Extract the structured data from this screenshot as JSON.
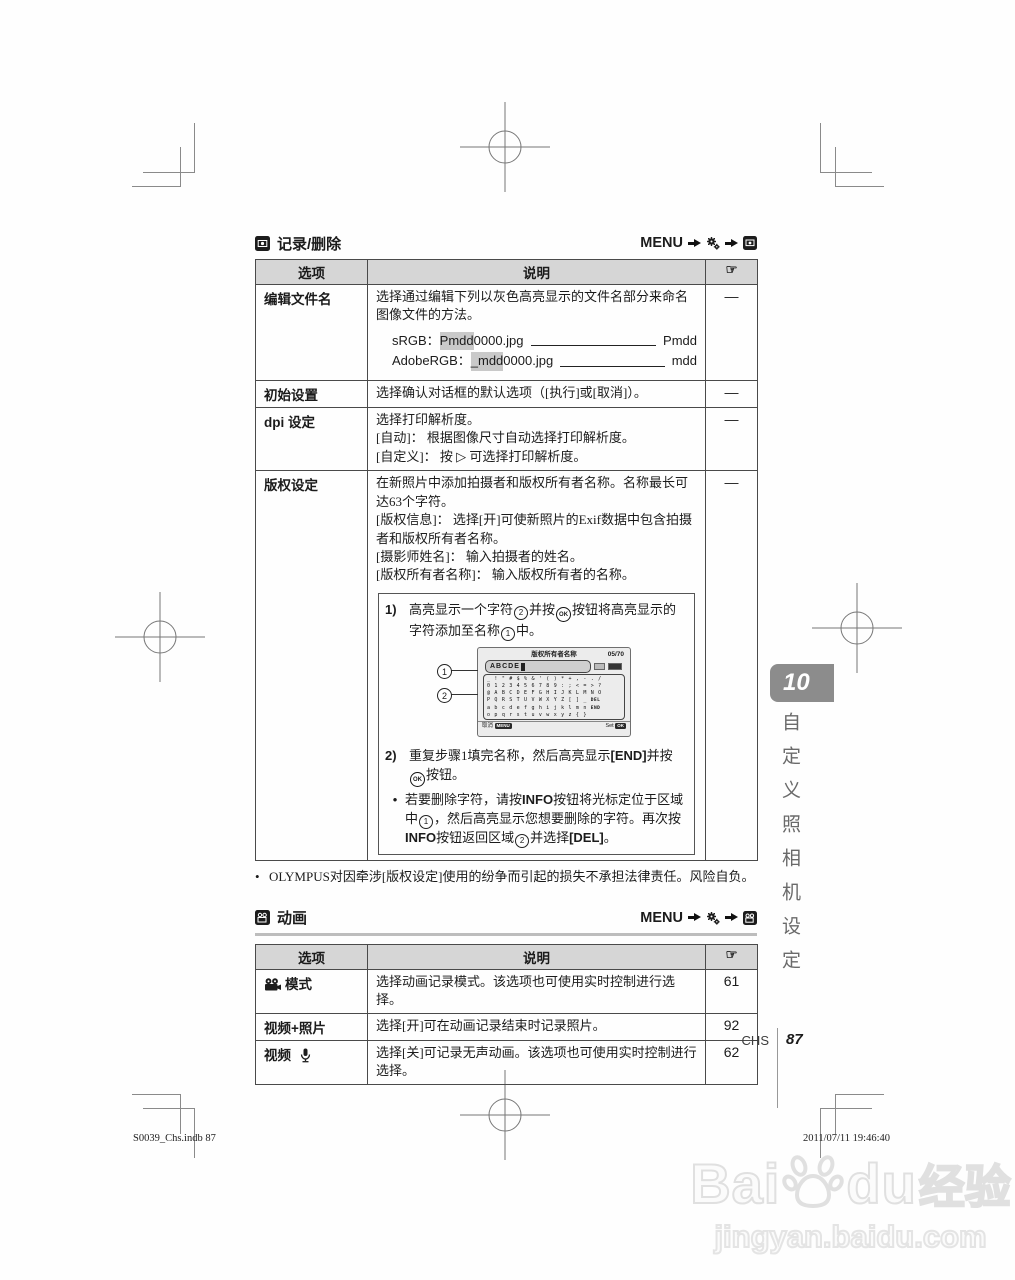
{
  "menu_path": {
    "menu": "MENU"
  },
  "section1": {
    "title": "记录/删除"
  },
  "section2": {
    "title": "动画"
  },
  "table_headers": {
    "option": "选项",
    "desc": "说明",
    "ref": "☞"
  },
  "table1": {
    "row1": {
      "option": "编辑文件名",
      "p1": "选择通过编辑下列以灰色高亮显示的文件名部分来命名图像文件的方法。",
      "srgb_label": "sRGB：",
      "srgb_hl": "Pmdd",
      "srgb_rest": "0000.jpg",
      "srgb_result": "Pmdd",
      "argb_label": "AdobeRGB：",
      "argb_hl": "_mdd",
      "argb_rest": "0000.jpg",
      "argb_result": "mdd",
      "ref": "—"
    },
    "row2": {
      "option": "初始设置",
      "desc": "选择确认对话框的默认选项（[执行]或[取消]）。",
      "ref": "—"
    },
    "row3": {
      "option": "dpi 设定",
      "l1": "选择打印解析度。",
      "l2": "[自动]： 根据图像尺寸自动选择打印解析度。",
      "l3a": "[自定义]： 按 ",
      "l3_tri": "▷",
      "l3b": " 可选择打印解析度。",
      "ref": "—"
    },
    "row4": {
      "option": "版权设定",
      "p1": "在新照片中添加拍摄者和版权所有者名称。名称最长可达63个字符。",
      "p2": "[版权信息]： 选择[开]可使新照片的Exif数据中包含拍摄者和版权所有者名称。",
      "p3": "[摄影师姓名]： 输入拍摄者的姓名。",
      "p4": "[版权所有者名称]： 输入版权所有者的名称。",
      "ref": "—",
      "step1": {
        "no": "1)",
        "t1": "高亮显示一个字符",
        "c2": "2",
        "t2": "并按",
        "ok": "OK",
        "t3": "按钮将高亮显示的字符添加至名称",
        "c1": "1",
        "t4": "中。"
      },
      "step2": {
        "no": "2)",
        "t1": "重复步骤1填完名称，然后高亮显示",
        "end": "[END]",
        "t2": "并按",
        "ok": "OK",
        "t3": "按钮。"
      },
      "bullet": {
        "mark": "•",
        "t1": "若要删除字符，请按",
        "info": "INFO",
        "t2": "按钮将光标定位于区域中",
        "c1": "1",
        "t3": "，然后高亮显示您想要删除的字符。再次按",
        "info2": "INFO",
        "t4": "按钮返回区域",
        "c2": "2",
        "t5": "并选择",
        "del": "[DEL]",
        "t6": "。"
      }
    }
  },
  "figure": {
    "title": "版权所有者名称",
    "counter": "05/70",
    "input": "ABCDE",
    "keyboard": {
      "rows": [
        "_!\"#$%&'()*+,-./",
        "0123456789:;<=>?",
        "@ABCDEFGHIJKLMNO",
        "PQRSTUVWXYZ[]_",
        "abcdefghijklmn",
        "opqrstuvwxyz{}"
      ],
      "del": "DEL",
      "end": "END"
    },
    "cancel": "取消",
    "cancel_btn": "MENU",
    "set": "Set",
    "set_btn": "OK",
    "callout1": "1",
    "callout2": "2"
  },
  "note1": {
    "mark": "•",
    "text": "OLYMPUS对因牵涉[版权设定]使用的纷争而引起的损失不承担法律责任。风险自负。"
  },
  "table2": {
    "rows": [
      {
        "option": "模式",
        "desc": "选择动画记录模式。该选项也可使用实时控制进行选择。",
        "ref": "61"
      },
      {
        "option": "视频+照片",
        "desc": "选择[开]可在动画记录结束时记录照片。",
        "ref": "92"
      },
      {
        "option": "视频",
        "desc": "选择[关]可记录无声动画。该选项也可使用实时控制进行选择。",
        "ref": "62"
      }
    ]
  },
  "footer": {
    "lang": "CHS",
    "page": "87",
    "chapter_tab": "10",
    "side_title": "自定义照相机设定",
    "left": "S0039_Chs.indb   87",
    "right": "2011/07/11   19:46:40"
  },
  "watermark": {
    "brand_a": "Bai",
    "brand_b": "du",
    "brand_c": "经验",
    "url": "jingyan.baidu.com"
  },
  "colors": {
    "header_bg": "#d6d6d6",
    "tab_gray": "#8c8c8c",
    "watermark": "#e0e0e0"
  }
}
